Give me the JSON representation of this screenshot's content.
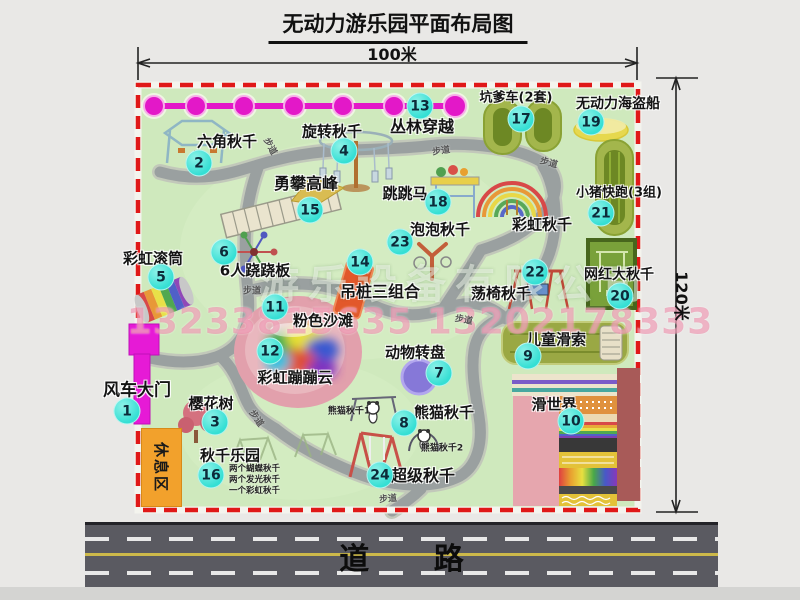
{
  "title": "无动力游乐园平面布局图",
  "dim": {
    "width": "100米",
    "height": "120米"
  },
  "road": {
    "label": "道 路"
  },
  "watermark": {
    "company": "游乐设备有限公司",
    "phone": "13233815635 13202178333"
  },
  "rest_area": {
    "label": "休息区"
  },
  "path_label": "步道",
  "colors": {
    "map_green": "#cfe9bd",
    "path_gray": "#9aa0a0",
    "border_red": "#e01818",
    "chain_magenta": "#e318c8",
    "badge_teal": "#35dfd4",
    "rest_orange": "#f2a12c",
    "road_gray": "#5a5a61",
    "beach_pink": "#e2a0ac",
    "gate_magenta": "#e61ad6"
  },
  "features": [
    {
      "num": "1",
      "name": "风车大门",
      "lx": 137,
      "ly": 388,
      "bx": 127,
      "by": 411,
      "ls": 17
    },
    {
      "num": "2",
      "name": "六角秋千",
      "lx": 227,
      "ly": 141,
      "bx": 199,
      "by": 163,
      "ls": 15
    },
    {
      "num": "3",
      "name": "樱花树",
      "lx": 211,
      "ly": 403,
      "bx": 215,
      "by": 422,
      "ls": 15
    },
    {
      "num": "4",
      "name": "旋转秋千",
      "lx": 332,
      "ly": 131,
      "bx": 344,
      "by": 151,
      "ls": 15
    },
    {
      "num": "5",
      "name": "彩虹滚筒",
      "lx": 153,
      "ly": 258,
      "bx": 161,
      "by": 277,
      "ls": 15
    },
    {
      "num": "6",
      "name": "6人跷跷板",
      "lx": 255,
      "ly": 270,
      "bx": 224,
      "by": 252,
      "ls": 15
    },
    {
      "num": "7",
      "name": "动物转盘",
      "lx": 415,
      "ly": 352,
      "bx": 439,
      "by": 373,
      "ls": 15
    },
    {
      "num": "8",
      "name": "熊猫秋千",
      "lx": 444,
      "ly": 412,
      "bx": 404,
      "by": 423,
      "ls": 15
    },
    {
      "num": "9",
      "name": "儿童滑索",
      "lx": 556,
      "ly": 339,
      "bx": 528,
      "by": 356,
      "ls": 15
    },
    {
      "num": "10",
      "name": "滑世界",
      "lx": 554,
      "ly": 404,
      "bx": 571,
      "by": 421,
      "ls": 15
    },
    {
      "num": "11",
      "name": "粉色沙滩",
      "lx": 323,
      "ly": 320,
      "bx": 275,
      "by": 307,
      "ls": 15
    },
    {
      "num": "12",
      "name": "彩虹蹦蹦云",
      "lx": 295,
      "ly": 377,
      "bx": 270,
      "by": 351,
      "ls": 15
    },
    {
      "num": "13",
      "name": "丛林穿越",
      "lx": 422,
      "ly": 125,
      "bx": 420,
      "by": 106,
      "ls": 16
    },
    {
      "num": "14",
      "name": "吊桩三组合",
      "lx": 380,
      "ly": 290,
      "bx": 360,
      "by": 262,
      "ls": 16
    },
    {
      "num": "15",
      "name": "勇攀高峰",
      "lx": 306,
      "ly": 182,
      "bx": 310,
      "by": 210,
      "ls": 16
    },
    {
      "num": "16",
      "name": "秋千乐园",
      "lx": 230,
      "ly": 455,
      "bx": 211,
      "by": 475,
      "ls": 15
    },
    {
      "num": "17",
      "name": "坑爹车(2套)",
      "lx": 516,
      "ly": 96,
      "bx": 521,
      "by": 119,
      "ls": 13
    },
    {
      "num": "18",
      "name": "跳跳马",
      "lx": 405,
      "ly": 193,
      "bx": 438,
      "by": 202,
      "ls": 15
    },
    {
      "num": "19",
      "name": "无动力海盗船",
      "lx": 618,
      "ly": 103,
      "bx": 591,
      "by": 122,
      "ls": 14
    },
    {
      "num": "20",
      "name": "网红大秋千",
      "lx": 619,
      "ly": 274,
      "bx": 620,
      "by": 296,
      "ls": 14
    },
    {
      "num": "21",
      "name": "小猪快跑(3组)",
      "lx": 619,
      "ly": 191,
      "bx": 601,
      "by": 213,
      "ls": 13
    },
    {
      "num": "22",
      "name": "荡椅秋千",
      "lx": 501,
      "ly": 293,
      "bx": 535,
      "by": 272,
      "ls": 15
    },
    {
      "num": "23",
      "name": "泡泡秋千",
      "lx": 440,
      "ly": 229,
      "bx": 400,
      "by": 242,
      "ls": 15
    },
    {
      "num": "24",
      "name": "超级秋千",
      "lx": 423,
      "ly": 474,
      "bx": 380,
      "by": 475,
      "ls": 16
    },
    {
      "num": "",
      "name": "彩虹秋千",
      "lx": 542,
      "ly": 224,
      "bx": 0,
      "by": 0,
      "ls": 15
    }
  ],
  "notes16": {
    "lines": [
      "两个蝴蝶秋千",
      "两个发光秋千",
      "一个彩虹秋千"
    ]
  },
  "mini_labels": [
    {
      "text": "熊猫秋千1",
      "x": 349,
      "y": 410
    },
    {
      "text": "熊猫秋千2",
      "x": 442,
      "y": 447
    }
  ],
  "path_label_positions": [
    {
      "x": 271,
      "y": 146,
      "r": 62
    },
    {
      "x": 441,
      "y": 150,
      "r": -8
    },
    {
      "x": 549,
      "y": 162,
      "r": 15
    },
    {
      "x": 252,
      "y": 290,
      "r": 0
    },
    {
      "x": 257,
      "y": 418,
      "r": 55
    },
    {
      "x": 464,
      "y": 319,
      "r": 10
    },
    {
      "x": 388,
      "y": 498,
      "r": -5
    }
  ]
}
